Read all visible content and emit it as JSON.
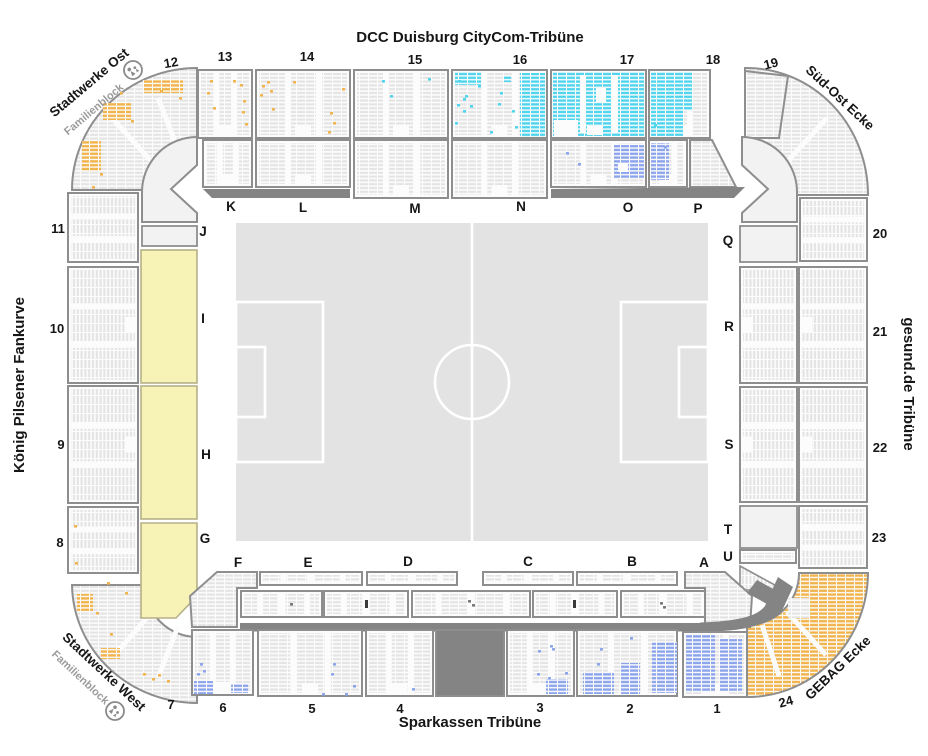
{
  "stands": {
    "north": "DCC Duisburg CityCom-Tribüne",
    "south": "Sparkassen Tribüne",
    "west": "König Pilsener Fankurve",
    "east": "gesund.de Tribüne"
  },
  "corners": {
    "northwest": {
      "name": "Stadtwerke Ost",
      "sub": "Familienblock"
    },
    "northeast": {
      "name": "Süd-Ost Ecke"
    },
    "southwest": {
      "name": "Stadtwerke West",
      "sub": "Familienblock"
    },
    "southeast": {
      "name": "GEBAG Ecke"
    }
  },
  "sections": {
    "1": "1",
    "2": "2",
    "3": "3",
    "4": "4",
    "5": "5",
    "6": "6",
    "7": "7",
    "8": "8",
    "9": "9",
    "10": "10",
    "11": "11",
    "12": "12",
    "13": "13",
    "14": "14",
    "15": "15",
    "16": "16",
    "17": "17",
    "18": "18",
    "19": "19",
    "20": "20",
    "21": "21",
    "22": "22",
    "23": "23",
    "24": "24"
  },
  "blocks": {
    "A": "A",
    "B": "B",
    "C": "C",
    "D": "D",
    "E": "E",
    "F": "F",
    "G": "G",
    "H": "H",
    "I": "I",
    "J": "J",
    "K": "K",
    "L": "L",
    "M": "M",
    "N": "N",
    "O": "O",
    "P": "P",
    "Q": "Q",
    "R": "R",
    "S": "S",
    "T": "T",
    "U": "U"
  },
  "colors": {
    "seat_row_gray": "#E4E4E4",
    "cyan_seats": "#4FD4EE",
    "blue_seats": "#8BA4EC",
    "orange_seats": "#F1B34A",
    "yellow_standing": "#F7F3B6",
    "walkway_dark": "#848484"
  }
}
